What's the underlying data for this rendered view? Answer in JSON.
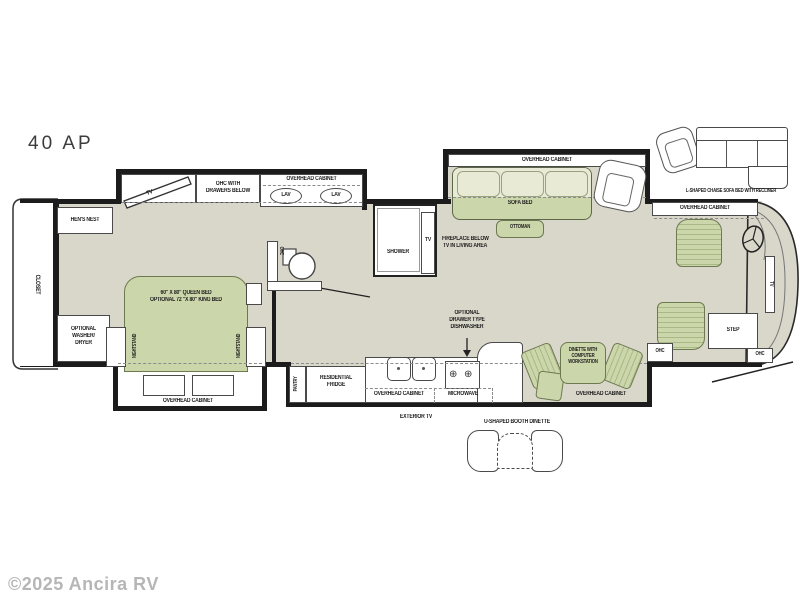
{
  "model": "40 AP",
  "watermark": "©2025 Ancira RV",
  "colors": {
    "floor": "#d9d6ca",
    "furniture_green": "#ccd6ab",
    "furniture_green_light": "#e9ead6",
    "wall": "#1c1c1c"
  },
  "icons": {
    "burner": "⊕"
  },
  "bedroom": {
    "closet": "CLOSET",
    "hens_nest": "HEN'S NEST",
    "tv": "TV",
    "ohc_drawers": [
      "OHC WITH",
      "DRAWERS BELOW"
    ],
    "washer": [
      "OPTIONAL",
      "WASHER/",
      "DRYER"
    ],
    "bed": [
      "60\" X 80\" QUEEN BED",
      "OPTIONAL 72 \"X 80\" KING BED"
    ],
    "nightstand": "NIGHTSTAND",
    "overhead_cabinet": "OVERHEAD CABINET"
  },
  "bath": {
    "overhead_cabinet": "OVERHEAD CABINET",
    "lav": "LAV",
    "ohc": "OHC",
    "shower": "SHOWER",
    "tv": "TV"
  },
  "living": {
    "overhead_cabinet": "OVERHEAD CABINET",
    "sofa_bed": "SOFA BED",
    "ottoman": "OTTOMAN",
    "fireplace": [
      "FIREPLACE BELOW",
      "TV IN LIVING AREA"
    ],
    "sofa_option": "L-SHAPED CHAISE SOFA BED WITH RECLINER"
  },
  "kitchen": {
    "pantry": "PANTRY",
    "fridge": [
      "RESIDENTIAL",
      "FRIDGE"
    ],
    "overhead_cabinet": "OVERHEAD CABINET",
    "microwave": "MICROWAVE",
    "dishwasher": [
      "OPTIONAL",
      "DRAWER TYPE",
      "DISHWASHER"
    ],
    "exterior_tv": "EXTERIOR TV"
  },
  "dinette": {
    "label": [
      "DINETTE WITH",
      "COMPUTER",
      "WORKSTATION"
    ],
    "overhead_cabinet": "OVERHEAD CABINET",
    "booth_option": "U-SHAPED BOOTH DINETTE"
  },
  "cockpit": {
    "overhead_cabinet": "OVERHEAD CABINET",
    "tv": "TV",
    "step": "STEP",
    "ohc_left": "OHC",
    "ohc_right": "OHC"
  }
}
